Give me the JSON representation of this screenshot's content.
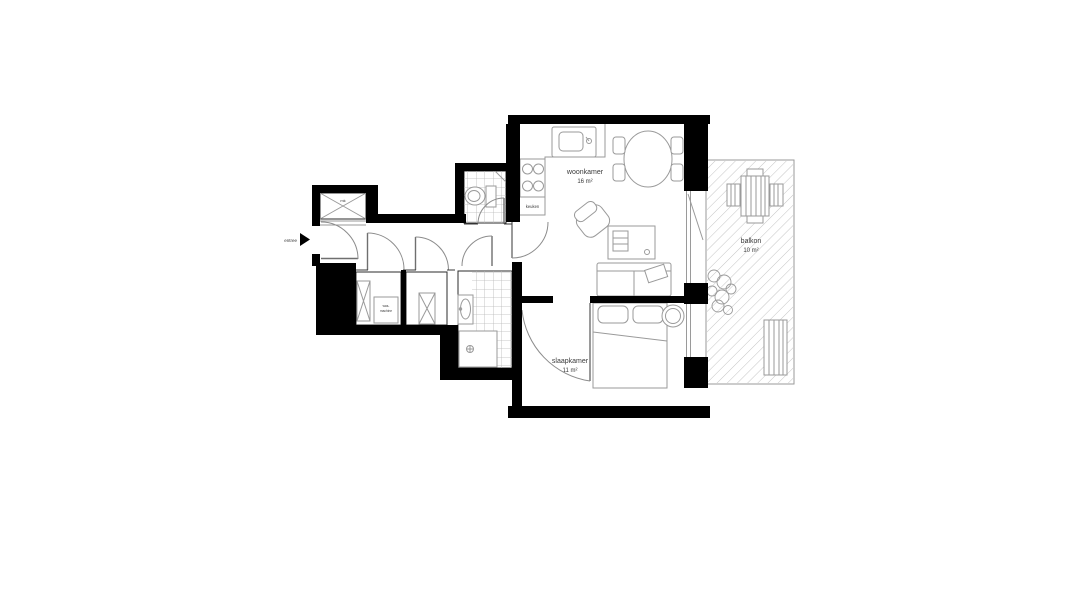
{
  "document": {
    "type": "apartment-floor-plan"
  },
  "colors": {
    "wall": "#000000",
    "furniture_line": "#9a9a9a",
    "tile_line": "#b8b8b8",
    "hatch_line": "#c4c4c4",
    "label_text": "#3a3a3a",
    "background": "#ffffff"
  },
  "rooms": {
    "living": {
      "name": "woonkamer",
      "area": "16 m²"
    },
    "bedroom": {
      "name": "slaapkamer",
      "area": "11 m²"
    },
    "balcony": {
      "name": "balkon",
      "area": "10 m²"
    },
    "kitchen": {
      "name": "keuken"
    },
    "meter": {
      "name": "mk"
    },
    "entrance": {
      "name": "entree"
    },
    "washer": {
      "line1": "was-",
      "line2": "machine"
    }
  }
}
